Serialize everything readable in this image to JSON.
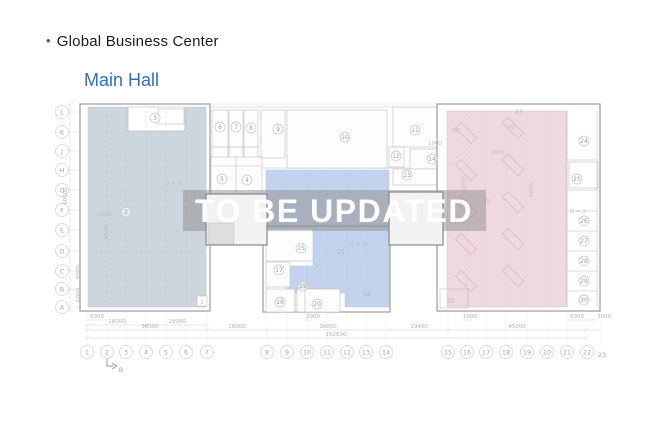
{
  "header": {
    "bullet": "•",
    "title": "Global Business Center",
    "subtitle": "Main Hall"
  },
  "watermark": {
    "text": "TO  BE UPDATED"
  },
  "colors": {
    "accent_blue": "#2b6fc7",
    "zone_left": "#c3cdd8",
    "zone_middle": "#b5c9ea",
    "zone_right": "#eed5de",
    "watermark_band": "#8a8a8a"
  },
  "plan": {
    "section_marker": "B",
    "grid_letters": [
      {
        "t": "L",
        "y": 112
      },
      {
        "t": "K",
        "y": 132
      },
      {
        "t": "J",
        "y": 151
      },
      {
        "t": "H",
        "y": 170
      },
      {
        "t": "G",
        "y": 190
      },
      {
        "t": "F",
        "y": 210
      },
      {
        "t": "E",
        "y": 230
      },
      {
        "t": "D",
        "y": 251
      },
      {
        "t": "C",
        "y": 271
      },
      {
        "t": "B",
        "y": 289
      },
      {
        "t": "A",
        "y": 307
      }
    ],
    "grid_numbers": [
      {
        "t": "1",
        "x": 87
      },
      {
        "t": "2",
        "x": 107
      },
      {
        "t": "3",
        "x": 126
      },
      {
        "t": "4",
        "x": 146
      },
      {
        "t": "5",
        "x": 166
      },
      {
        "t": "6",
        "x": 186
      },
      {
        "t": "7",
        "x": 207
      },
      {
        "t": "8",
        "x": 267
      },
      {
        "t": "9",
        "x": 287
      },
      {
        "t": "10",
        "x": 307
      },
      {
        "t": "11",
        "x": 327
      },
      {
        "t": "12",
        "x": 347
      },
      {
        "t": "13",
        "x": 366
      },
      {
        "t": "14",
        "x": 386
      },
      {
        "t": "15",
        "x": 448
      },
      {
        "t": "16",
        "x": 467
      },
      {
        "t": "17",
        "x": 486
      },
      {
        "t": "18",
        "x": 506
      },
      {
        "t": "19",
        "x": 527
      },
      {
        "t": "20",
        "x": 547
      },
      {
        "t": "21",
        "x": 567
      },
      {
        "t": "22",
        "x": 587
      }
    ],
    "grid_number_23": {
      "t": "23",
      "x": 602,
      "y": 357
    },
    "rooms_circled": [
      {
        "t": "3",
        "x": 155,
        "y": 118
      },
      {
        "t": "2",
        "x": 126,
        "y": 212
      },
      {
        "t": "6",
        "x": 220,
        "y": 127
      },
      {
        "t": "7",
        "x": 236,
        "y": 127
      },
      {
        "t": "8",
        "x": 251,
        "y": 128
      },
      {
        "t": "9",
        "x": 278,
        "y": 129
      },
      {
        "t": "10",
        "x": 345,
        "y": 137
      },
      {
        "t": "11",
        "x": 415,
        "y": 130
      },
      {
        "t": "12",
        "x": 396,
        "y": 156
      },
      {
        "t": "13",
        "x": 407,
        "y": 175
      },
      {
        "t": "14",
        "x": 432,
        "y": 159
      },
      {
        "t": "5",
        "x": 222,
        "y": 179
      },
      {
        "t": "4",
        "x": 247,
        "y": 180
      },
      {
        "t": "15",
        "x": 301,
        "y": 248
      },
      {
        "t": "17",
        "x": 279,
        "y": 270
      },
      {
        "t": "19",
        "x": 303,
        "y": 286
      },
      {
        "t": "18",
        "x": 280,
        "y": 302
      },
      {
        "t": "20",
        "x": 317,
        "y": 304
      },
      {
        "t": "24",
        "x": 584,
        "y": 141
      },
      {
        "t": "25",
        "x": 577,
        "y": 179
      },
      {
        "t": "26",
        "x": 584,
        "y": 221
      },
      {
        "t": "27",
        "x": 584,
        "y": 241
      },
      {
        "t": "28",
        "x": 584,
        "y": 261
      },
      {
        "t": "29",
        "x": 584,
        "y": 281
      },
      {
        "t": "30",
        "x": 584,
        "y": 300
      }
    ],
    "rooms_plain": [
      {
        "t": "21",
        "x": 341,
        "y": 254
      },
      {
        "t": "22",
        "x": 367,
        "y": 296
      },
      {
        "t": "31",
        "x": 486,
        "y": 203
      },
      {
        "t": "32",
        "x": 451,
        "y": 303
      },
      {
        "t": "23",
        "x": 519,
        "y": 114
      },
      {
        "t": "1",
        "x": 202,
        "y": 304
      }
    ],
    "annotations": [
      {
        "t": "Q = 3",
        "x": 173,
        "y": 185
      },
      {
        "t": "Q = 3",
        "x": 358,
        "y": 246
      },
      {
        "t": "Q = 3",
        "x": 477,
        "y": 228
      },
      {
        "t": "Q = 3",
        "x": 578,
        "y": 213
      },
      {
        "t": "2000",
        "x": 104,
        "y": 216
      },
      {
        "t": "1900",
        "x": 497,
        "y": 154
      },
      {
        "t": "1000",
        "x": 435,
        "y": 145
      },
      {
        "t": "45°",
        "x": 456,
        "y": 132
      },
      {
        "t": "45°",
        "x": 512,
        "y": 129
      },
      {
        "t": "5000",
        "x": 108,
        "y": 232,
        "rot": 1
      },
      {
        "t": "6000",
        "x": 465,
        "y": 184,
        "rot": 1
      },
      {
        "t": "6000",
        "x": 533,
        "y": 190,
        "rot": 1
      }
    ],
    "dims": [
      {
        "t": "6000",
        "x": 97,
        "y": 318
      },
      {
        "t": "2000",
        "x": 313,
        "y": 318
      },
      {
        "t": "1000",
        "x": 470,
        "y": 318
      },
      {
        "t": "6000",
        "x": 577,
        "y": 318
      },
      {
        "t": "3000",
        "x": 604,
        "y": 318
      },
      {
        "t": "18000",
        "x": 117,
        "y": 323
      },
      {
        "t": "18000",
        "x": 177,
        "y": 323
      },
      {
        "t": "36000",
        "x": 150,
        "y": 328
      },
      {
        "t": "18000",
        "x": 237,
        "y": 328
      },
      {
        "t": "36000",
        "x": 328,
        "y": 328
      },
      {
        "t": "19400",
        "x": 419,
        "y": 328
      },
      {
        "t": "45000",
        "x": 517,
        "y": 328
      },
      {
        "t": "152600",
        "x": 336,
        "y": 336
      },
      {
        "t": "60000",
        "x": 67,
        "y": 196,
        "rot": 1
      },
      {
        "t": "6000",
        "x": 80,
        "y": 272,
        "rot": 1
      },
      {
        "t": "6000",
        "x": 80,
        "y": 295,
        "rot": 1
      }
    ]
  }
}
